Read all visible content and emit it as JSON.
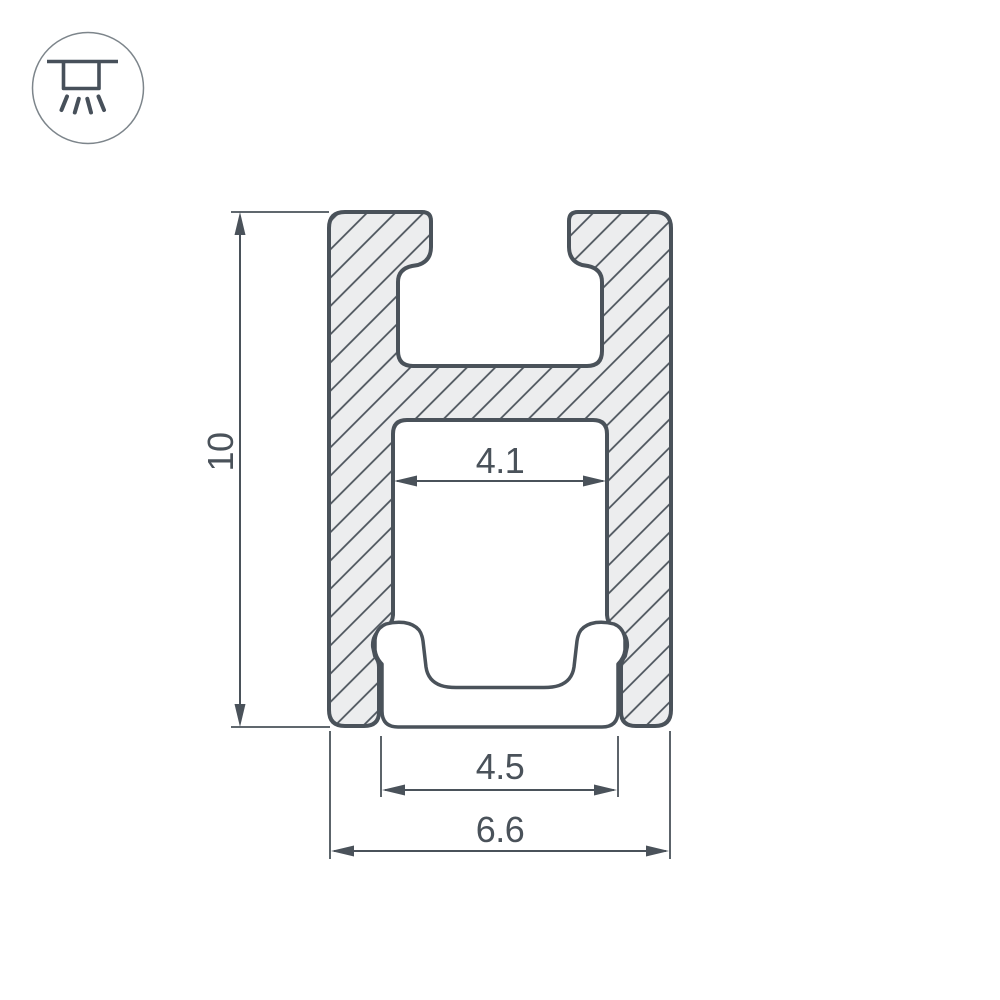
{
  "badge": {
    "icon": "recessed-ceiling-light-icon"
  },
  "drawing": {
    "subject": "led-profile-cross-section",
    "labels": {
      "height": "10",
      "slot_width": "4.1",
      "cover_width": "4.5",
      "overall_width": "6.6"
    },
    "colors": {
      "outline": "#4A525A",
      "fill": "#ECEDEE",
      "dimension": "#4A525A",
      "badge_circle": "#7D858B"
    }
  }
}
